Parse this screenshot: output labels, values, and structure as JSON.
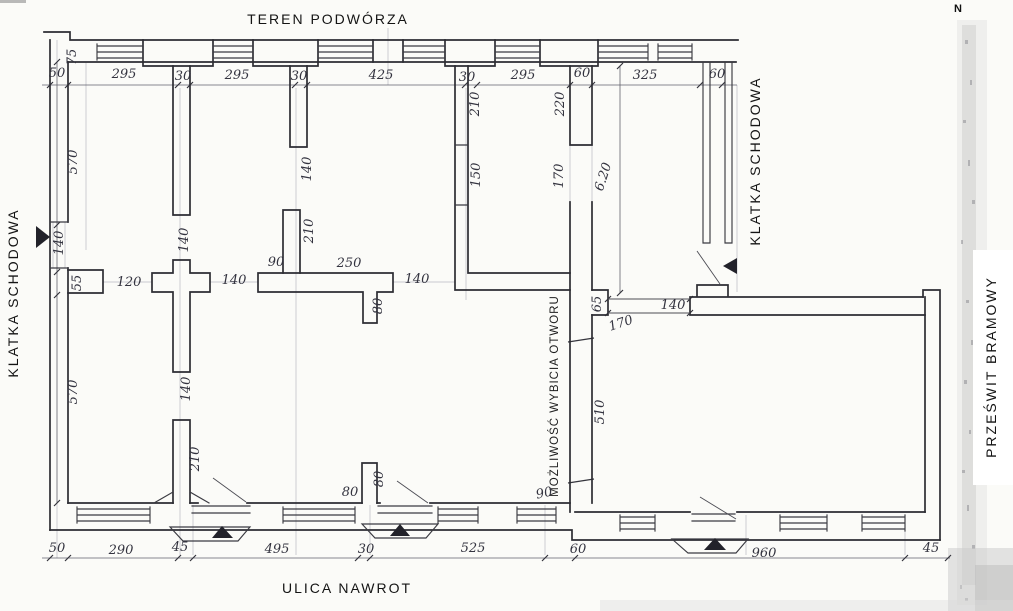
{
  "area_labels": [
    {
      "name": "label-teren-podworza",
      "text": "TEREN PODWÓRZA",
      "x": 328,
      "y": 24,
      "rotate": 0,
      "cls": "big"
    },
    {
      "name": "label-ulica-nawrot",
      "text": "ULICA NAWROT",
      "x": 347,
      "y": 593,
      "rotate": 0,
      "cls": "big"
    },
    {
      "name": "label-klatka-schodowa-left",
      "text": "KLATKA SCHODOWA",
      "x": 18,
      "y": 293,
      "rotate": -90,
      "cls": "big"
    },
    {
      "name": "label-klatka-schodowa-right",
      "text": "KLATKA SCHODOWA",
      "x": 760,
      "y": 161,
      "rotate": -90,
      "cls": "big"
    },
    {
      "name": "label-przeswit-bramowy",
      "text": "PRZEŚWIT BRAMOWY",
      "x": 996,
      "y": 367,
      "rotate": -90,
      "cls": "big"
    },
    {
      "name": "label-mozliwosc-wybicia-otworu",
      "text": "MOŻLIWOŚĆ WYBICIA OTWORU",
      "x": 558,
      "y": 396,
      "rotate": -90,
      "cls": "mid"
    },
    {
      "name": "north-indicator",
      "text": "N",
      "x": 958,
      "y": 12,
      "rotate": 0,
      "cls": "north"
    }
  ],
  "dimension_labels": [
    {
      "text": "75",
      "x": 76,
      "y": 57,
      "rotate": -90
    },
    {
      "text": "50",
      "x": 57,
      "y": 77,
      "rotate": 0
    },
    {
      "text": "295",
      "x": 124,
      "y": 78,
      "rotate": 0
    },
    {
      "text": "30",
      "x": 183,
      "y": 80,
      "rotate": 0
    },
    {
      "text": "295",
      "x": 237,
      "y": 79,
      "rotate": 0
    },
    {
      "text": "30",
      "x": 299,
      "y": 80,
      "rotate": 0
    },
    {
      "text": "425",
      "x": 381,
      "y": 79,
      "rotate": 0
    },
    {
      "text": "30",
      "x": 467,
      "y": 81,
      "rotate": 0
    },
    {
      "text": "295",
      "x": 523,
      "y": 79,
      "rotate": 0
    },
    {
      "text": "60",
      "x": 582,
      "y": 77,
      "rotate": 0
    },
    {
      "text": "325",
      "x": 645,
      "y": 79,
      "rotate": 0
    },
    {
      "text": "60",
      "x": 717,
      "y": 78,
      "rotate": 0
    },
    {
      "text": "570",
      "x": 77,
      "y": 162,
      "rotate": -90
    },
    {
      "text": "140",
      "x": 63,
      "y": 243,
      "rotate": -90
    },
    {
      "text": "55",
      "x": 81,
      "y": 283,
      "rotate": -90
    },
    {
      "text": "570",
      "x": 77,
      "y": 392,
      "rotate": -90
    },
    {
      "text": "50",
      "x": 57,
      "y": 552,
      "rotate": 0
    },
    {
      "text": "290",
      "x": 121,
      "y": 554,
      "rotate": 0
    },
    {
      "text": "45",
      "x": 180,
      "y": 551,
      "rotate": 0
    },
    {
      "text": "495",
      "x": 277,
      "y": 553,
      "rotate": 0
    },
    {
      "text": "30",
      "x": 366,
      "y": 553,
      "rotate": 0
    },
    {
      "text": "525",
      "x": 473,
      "y": 552,
      "rotate": 0
    },
    {
      "text": "60",
      "x": 578,
      "y": 553,
      "rotate": 0
    },
    {
      "text": "960",
      "x": 764,
      "y": 557,
      "rotate": 0
    },
    {
      "text": "45",
      "x": 931,
      "y": 552,
      "rotate": 0
    },
    {
      "text": "140",
      "x": 311,
      "y": 169,
      "rotate": -90
    },
    {
      "text": "210",
      "x": 313,
      "y": 231,
      "rotate": -90
    },
    {
      "text": "210",
      "x": 479,
      "y": 104,
      "rotate": -90
    },
    {
      "text": "150",
      "x": 480,
      "y": 175,
      "rotate": -90
    },
    {
      "text": "220",
      "x": 564,
      "y": 104,
      "rotate": -90
    },
    {
      "text": "170",
      "x": 563,
      "y": 176,
      "rotate": -90
    },
    {
      "text": "6.20",
      "x": 607,
      "y": 178,
      "rotate": -72
    },
    {
      "text": "140",
      "x": 188,
      "y": 240,
      "rotate": -90
    },
    {
      "text": "120",
      "x": 129,
      "y": 286,
      "rotate": 0
    },
    {
      "text": "140",
      "x": 234,
      "y": 284,
      "rotate": 0
    },
    {
      "text": "90",
      "x": 276,
      "y": 266,
      "rotate": 0
    },
    {
      "text": "250",
      "x": 349,
      "y": 267,
      "rotate": 0
    },
    {
      "text": "80",
      "x": 382,
      "y": 306,
      "rotate": -90
    },
    {
      "text": "140",
      "x": 417,
      "y": 283,
      "rotate": 0
    },
    {
      "text": "140",
      "x": 190,
      "y": 389,
      "rotate": -90
    },
    {
      "text": "210",
      "x": 199,
      "y": 459,
      "rotate": -90
    },
    {
      "text": "65",
      "x": 601,
      "y": 304,
      "rotate": -90
    },
    {
      "text": "170",
      "x": 622,
      "y": 327,
      "rotate": -18
    },
    {
      "text": "510",
      "x": 604,
      "y": 412,
      "rotate": -90
    },
    {
      "text": "90",
      "x": 545,
      "y": 497,
      "rotate": -12
    },
    {
      "text": "80",
      "x": 350,
      "y": 496,
      "rotate": 0
    },
    {
      "text": "80",
      "x": 383,
      "y": 479,
      "rotate": -90
    },
    {
      "text": "140",
      "x": 673,
      "y": 309,
      "rotate": 0
    }
  ]
}
